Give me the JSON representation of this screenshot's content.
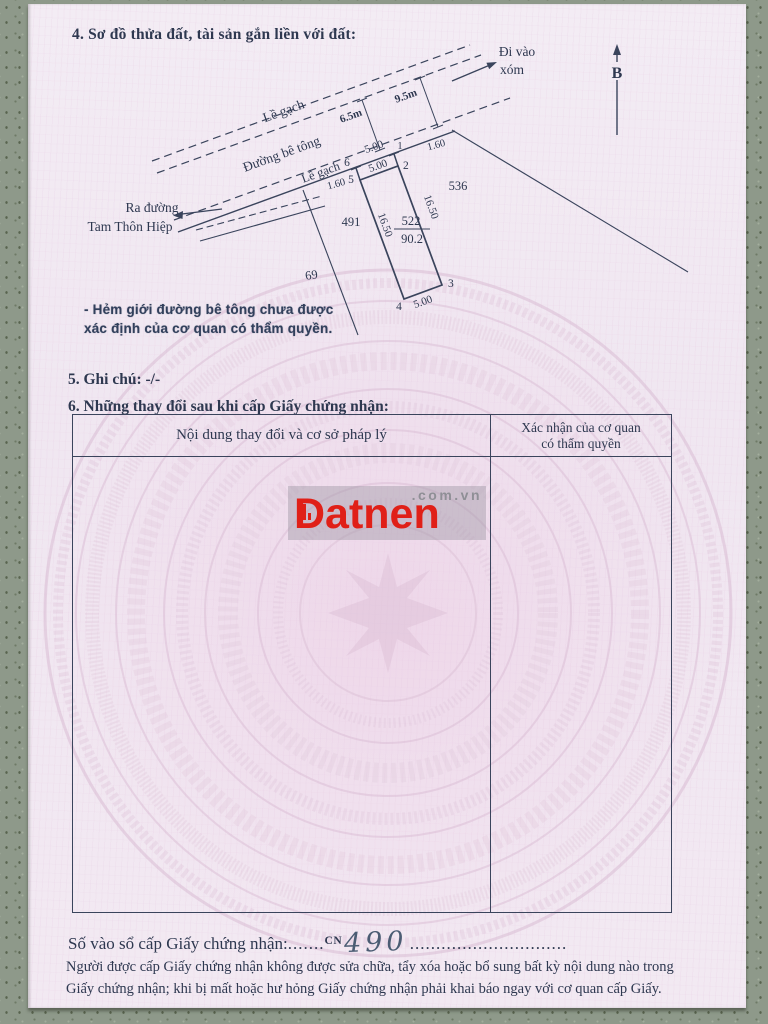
{
  "page": {
    "title": "4. Sơ đồ thửa đất, tài sản gắn liền với đất:",
    "section5": "5. Ghi chú: -/-",
    "section6": "6. Những thay đổi sau khi cấp Giấy chứng nhận:"
  },
  "diagram": {
    "direction_line1": "Đi vào",
    "direction_line2": "xóm",
    "north": "B",
    "exit_line1": "Ra đường",
    "exit_line2": "Tam Thôn Hiệp",
    "sidewalk_top": "Lề gạch",
    "road": "Đường bê tông",
    "sidewalk_bottom": "Lề gạch",
    "dim_road_width": "6.5m",
    "dim_total_width": "9.5m",
    "parcel": {
      "number": "522",
      "area": "90.2"
    },
    "neighbors": {
      "left": "491",
      "right": "536",
      "bottom_left": "69"
    },
    "dims": {
      "top": "5.00",
      "inner_top": "5.00",
      "bottom": "5.00",
      "left": "16.50",
      "right": "16.50",
      "offset_left": "1.60",
      "offset_right": "1.60"
    },
    "points": {
      "p1": "1",
      "p2": "2",
      "p3": "3",
      "p4": "4",
      "p5": "5",
      "p6": "6"
    },
    "note_line1": "- Hẻm giới đường bê tông chưa được",
    "note_line2": "xác định của cơ quan có thẩm quyền."
  },
  "table": {
    "col1_header": "Nội dung thay đổi và cơ sở pháp lý",
    "col2_header_line1": "Xác nhận của cơ quan",
    "col2_header_line2": "có thẩm quyền"
  },
  "watermark_logo": {
    "brand": "Datnen",
    "suffix": ".com.vn"
  },
  "footer": {
    "serial_label": "Số vào sổ cấp Giấy chứng nhận:",
    "serial_dots_left": ".......",
    "serial_code": "CN",
    "serial_number": "490",
    "serial_dots_right": "..............................",
    "disclaimer_line1": "Người được cấp Giấy chứng nhận không được sửa chữa, tẩy xóa hoặc bổ sung bất kỳ nội dung nào trong",
    "disclaimer_line2": "Giấy chứng nhận; khi bị mất hoặc hư hỏng Giấy chứng nhận phải khai báo ngay với cơ quan cấp Giấy."
  },
  "colors": {
    "brand_red": "#e02018",
    "paper_pink": "#f1e9f2",
    "ink": "#2e3850"
  }
}
